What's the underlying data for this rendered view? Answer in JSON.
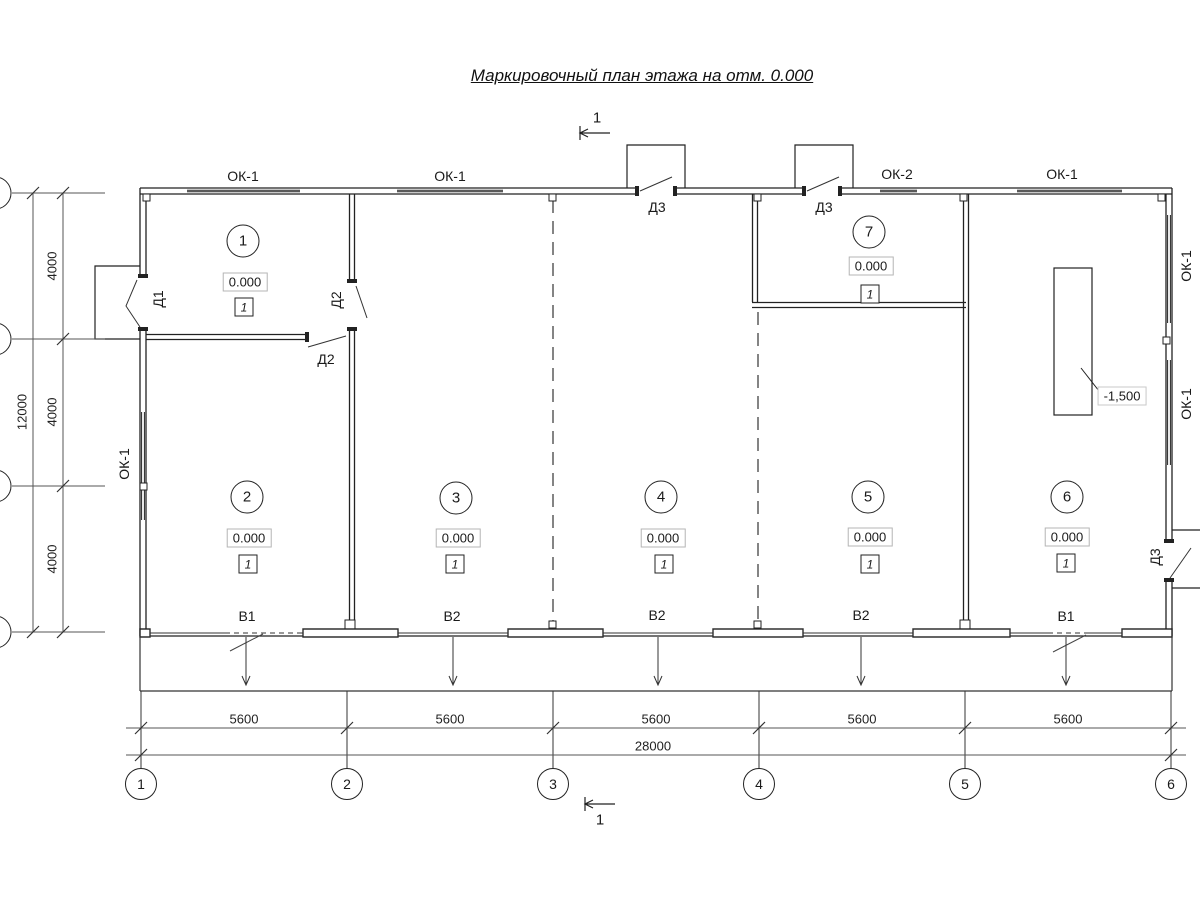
{
  "title": "Маркировочный план этажа на отм. 0.000",
  "section_mark": {
    "label": "1"
  },
  "windows": {
    "top": [
      "ОК-1",
      "ОК-1",
      "ОК-2",
      "ОК-1"
    ],
    "left": [
      "ОК-1"
    ],
    "right": [
      "ОК-1",
      "ОК-1"
    ]
  },
  "doors": {
    "d1": "Д1",
    "d2": "Д2",
    "d3": "Д3"
  },
  "rooms": [
    {
      "number": "1",
      "elevation": "0.000",
      "type_mark": "1"
    },
    {
      "number": "2",
      "elevation": "0.000",
      "type_mark": "1"
    },
    {
      "number": "3",
      "elevation": "0.000",
      "type_mark": "1"
    },
    {
      "number": "4",
      "elevation": "0.000",
      "type_mark": "1"
    },
    {
      "number": "5",
      "elevation": "0.000",
      "type_mark": "1"
    },
    {
      "number": "6",
      "elevation": "0.000",
      "type_mark": "1"
    },
    {
      "number": "7",
      "elevation": "0.000",
      "type_mark": "1"
    }
  ],
  "gates": [
    "В1",
    "В2",
    "В2",
    "В2",
    "В1"
  ],
  "pit": {
    "label": "-1,500"
  },
  "dimensions": {
    "left_segments": [
      "4000",
      "4000",
      "4000"
    ],
    "left_total": "12000",
    "bottom_segments": [
      "5600",
      "5600",
      "5600",
      "5600",
      "5600"
    ],
    "bottom_total": "28000"
  },
  "axes": [
    "1",
    "2",
    "3",
    "4",
    "5",
    "6"
  ]
}
